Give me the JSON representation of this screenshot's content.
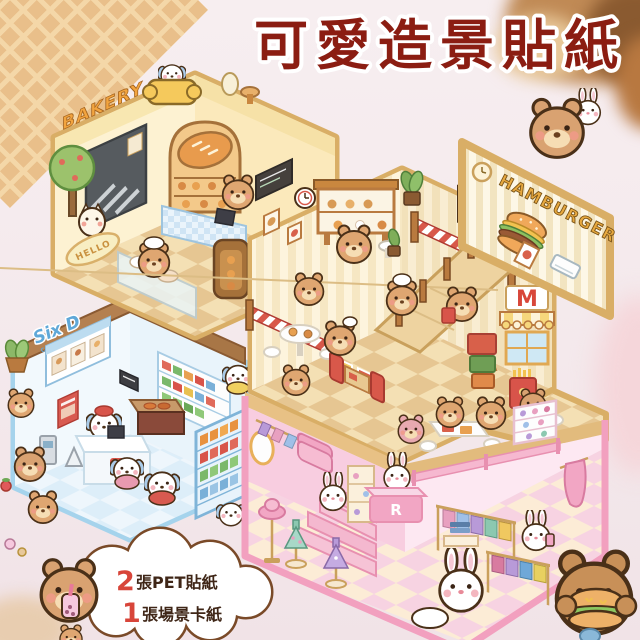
{
  "title": {
    "text": "可愛造景貼紙",
    "color": "#8b1d12"
  },
  "scenes": {
    "bakery": {
      "sign": "BAKERY",
      "doormat": "HELLO"
    },
    "convenience_store": {
      "sign_line1": "Six D",
      "sign_line2": "CONVENIENCE STO",
      "brand_badge": "6"
    },
    "burger_restaurant": {
      "exterior_sign": "HAMBURGER",
      "arch_sign": "M"
    },
    "boutique": {
      "counter_sign": "R"
    }
  },
  "callout": {
    "line1_qty": "2",
    "line1_label": "張PET貼紙",
    "line2_qty": "1",
    "line2_label": "張場景卡紙"
  },
  "palette": {
    "background": "#f5ecee",
    "bakery_cream": "#fdf1cf",
    "bakery_border": "#d9ae66",
    "store_blue": "#eef6fc",
    "store_border": "#a5d3ec",
    "restaurant_red": "#d8584a",
    "boutique_pink": "#f2a6c4",
    "bear_brown": "#dfa671"
  }
}
